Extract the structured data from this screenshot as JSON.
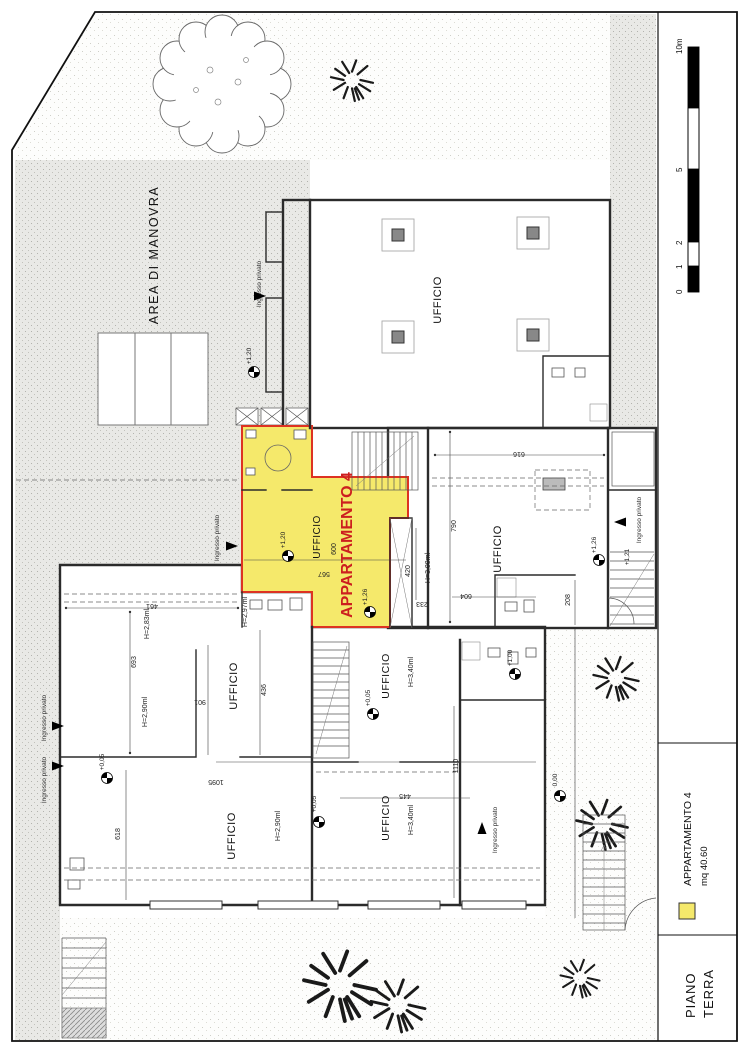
{
  "sheet": {
    "floor_line1": "PIANO",
    "floor_line2": "TERRA"
  },
  "legend": {
    "name": "APPARTAMENTO 4",
    "area": "mq 40.60"
  },
  "scale_bar": {
    "ticks": [
      "0",
      "1",
      "2",
      "5",
      "10m"
    ]
  },
  "site": {
    "area_label": "AREA DI MANOVRA",
    "entrance_label": "Ingresso privato"
  },
  "apartment": {
    "name": "APPARTAMENTO 4"
  },
  "rooms": {
    "office": "UFFICIO"
  },
  "heights": {
    "h283": "H=2,83ml",
    "h290": "H=2,90ml",
    "h297": "H=2,97ml",
    "h300": "H=3,00ml",
    "h340": "H=3,40ml"
  },
  "levels": {
    "l120": "+1,20",
    "l121": "+1,21",
    "l126": "+1,26",
    "l100": "+1,00",
    "l000": "0,00",
    "l005": "+0,05"
  },
  "dims": {
    "d461": "461",
    "d693": "693",
    "d901": "901",
    "d436": "436",
    "d618": "618",
    "d1095": "1095",
    "d445": "445",
    "d1110": "1110",
    "d600": "600",
    "d567": "567",
    "d420": "420",
    "d233": "233",
    "d604": "604",
    "d790": "790",
    "d616": "616",
    "d208": "208"
  },
  "colors": {
    "apartment_fill": "#f5e96b",
    "apartment_outline": "#dd3322",
    "accent_text": "#cc1f1f"
  }
}
